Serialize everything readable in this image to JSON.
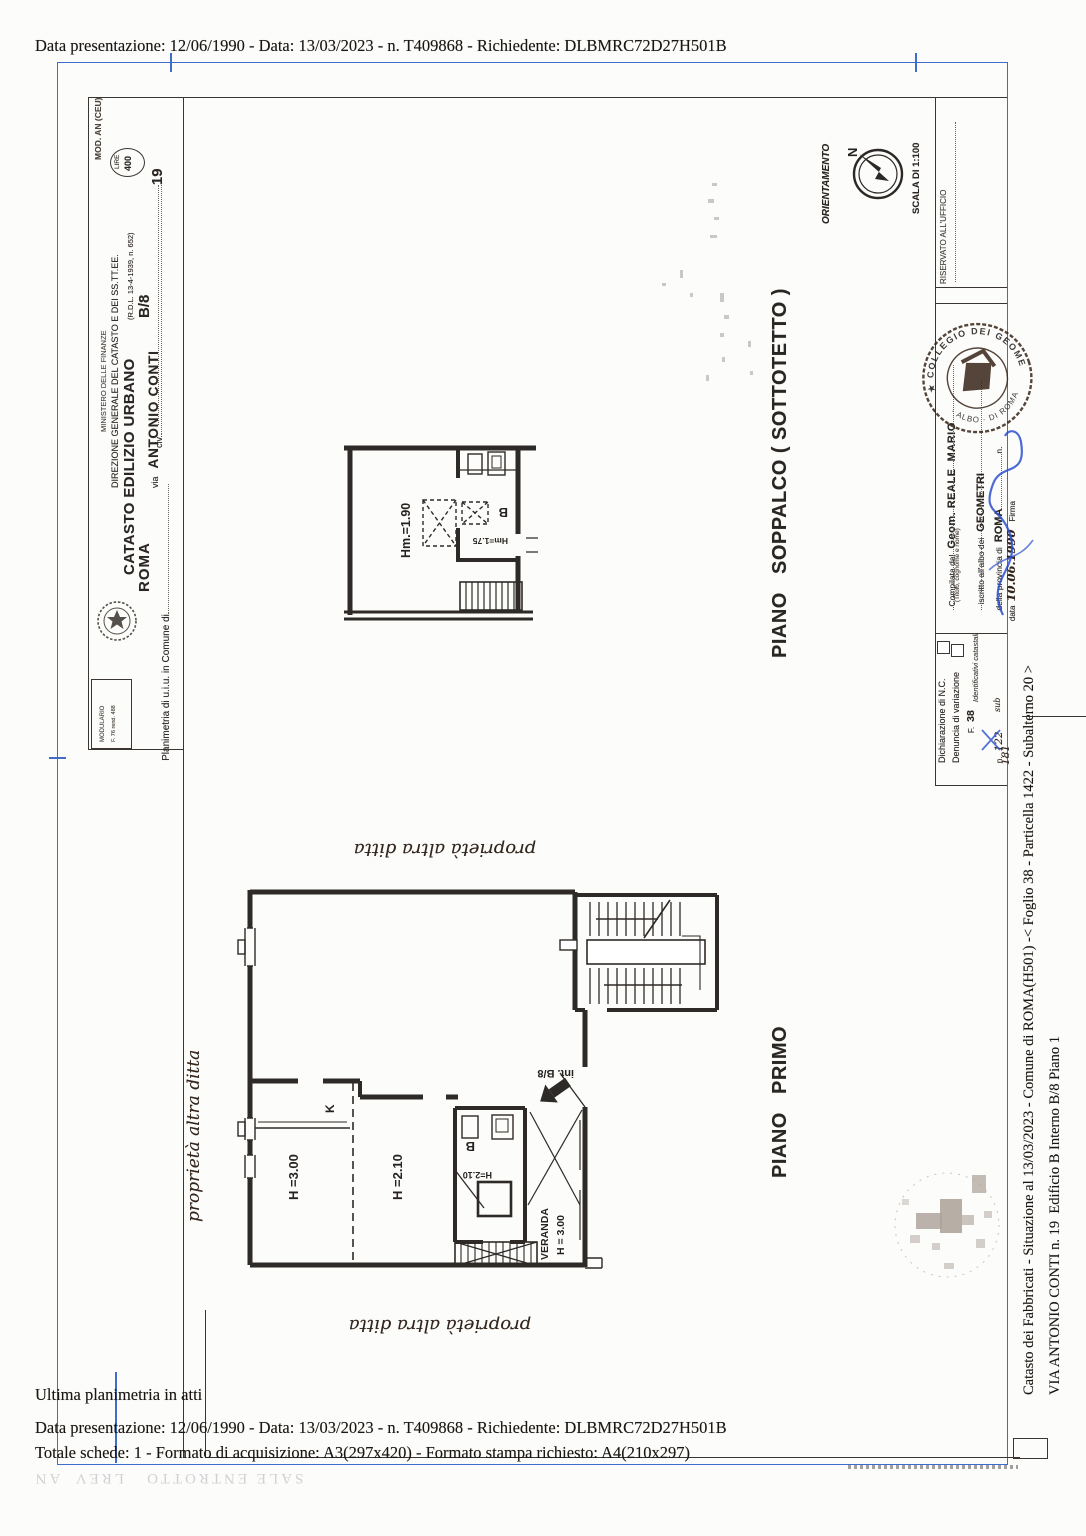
{
  "doc": {
    "top_line": "Data presentazione: 12/06/1990 - Data: 13/03/2023 - n. T409868 - Richiedente: DLBMRC72D27H501B",
    "footer": {
      "line1": "Ultima planimetria in atti",
      "line2": "Data presentazione: 12/06/1990 - Data: 13/03/2023 - n. T409868 - Richiedente: DLBMRC72D27H501B",
      "line3": "Totale schede: 1 - Formato di acquisizione: A3(297x420)  - Formato stampa richiesto: A4(210x297)",
      "bleedthrough": "SALE ENTROTTO   LREV  AN"
    },
    "margin_caption": {
      "line1": "Catasto dei Fabbricati - Situazione al 13/03/2023 - Comune di ROMA(H501) -< Foglio 38 - Particella 1422 - Subalterno 20 >",
      "line2": "VIA ANTONIO CONTI n. 19  Edificio B Interno B/8 Piano 1"
    },
    "form_header": {
      "mod": "MOD. AN (CEU)",
      "lire_label": "LIRE",
      "lire_value": "400",
      "ministero": "MINISTERO DELLE FINANZE",
      "direzione": "DIREZIONE GENERALE DEL CATASTO E DEI SS.TT.EE.",
      "catasto": "CATASTO EDILIZIO URBANO",
      "rdl": "(R.D.L. 13-4-1939, n. 652)",
      "planimetria_label": "Planimetria di u.i.u. in Comune di",
      "comune_value": "ROMA",
      "via_label": "via",
      "via_value": "ANTONIO CONTI",
      "interno_value": "B/8",
      "civ_label": "civ.",
      "civ_value": "19",
      "modulario1": "MODULARIO",
      "modulario2": "F. 76 rend. 488"
    },
    "orientation": {
      "label": "ORIENTAMENTO",
      "north": "N",
      "scala": "SCALA DI 1:100",
      "riservato": "RISERVATO ALL'UFFICIO"
    },
    "compiler": {
      "compilata_label": "Compilata dal",
      "nome": "Geom. REALE  MARIO",
      "titolo": "(Titolo, cognome e nome)",
      "iscritto_label": "iscritto all'albo dei",
      "albo_value": "GEOMETRI",
      "provincia_label": "della provincia di",
      "provincia_value": "ROMA",
      "n_label": "n.",
      "data_label": "data",
      "data_value": "10.06.1990",
      "firma_label": "Firma",
      "stamp_top": "★ COLLEGIO DEI GEOMETRI ★",
      "stamp_bottom": "· ALBO · DI ROMA ·"
    },
    "declaration": {
      "line1": "Dichiarazione di N.C.",
      "line2": "Denuncia di variazione",
      "ident": "Identificativi catastali",
      "f_label": "F.",
      "f_value": "38",
      "n_label": "n.",
      "n_value": "122",
      "sub_label": "sub",
      "sub_value": "181"
    },
    "plans": {
      "soppalco": {
        "title": "PIANO   SOPPALCO ( SOTTOTETTO )",
        "hm1": "Hm.=1.90",
        "hm2": "Hm=1.75",
        "b": "B"
      },
      "primo": {
        "title": "PIANO   PRIMO",
        "h300": "H =3.00",
        "h210": "H =2.10",
        "k": "K",
        "b": "B",
        "bh": "H=2.10",
        "veranda1": "VERANDA",
        "veranda2": "H = 3.00",
        "int": "int. B/8"
      },
      "handwriting_note": "proprietà altra ditta"
    }
  }
}
